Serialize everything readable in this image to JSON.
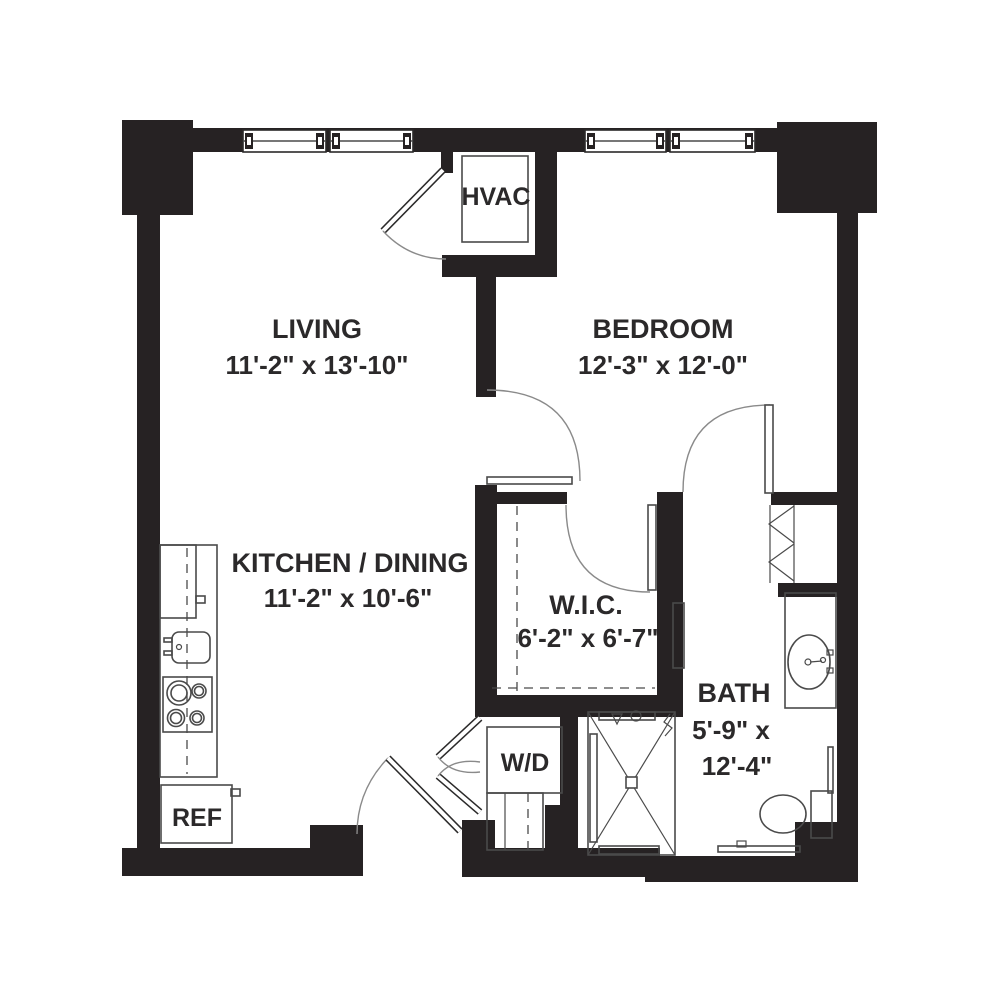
{
  "plan": {
    "rooms": {
      "living": {
        "name": "LIVING",
        "dims": "11'-2\" x 13'-10\""
      },
      "bedroom": {
        "name": "BEDROOM",
        "dims": "12'-3\" x 12'-0\""
      },
      "kitchen": {
        "name": "KITCHEN / DINING",
        "dims": "11'-2\" x 10'-6\""
      },
      "wic": {
        "name": "W.I.C.",
        "dims": "6'-2\" x 6'-7\""
      },
      "bath": {
        "name": "BATH",
        "dims_line1": "5'-9\" x",
        "dims_line2": "12'-4\""
      }
    },
    "fixtures": {
      "hvac": "HVAC",
      "washer_dryer": "W/D",
      "refrigerator": "REF"
    },
    "colors": {
      "wall": "#262223",
      "fixture_line": "#4a4a4a",
      "text": "#2b292a",
      "door_arc": "#8a8a8a",
      "background": "#ffffff"
    }
  }
}
